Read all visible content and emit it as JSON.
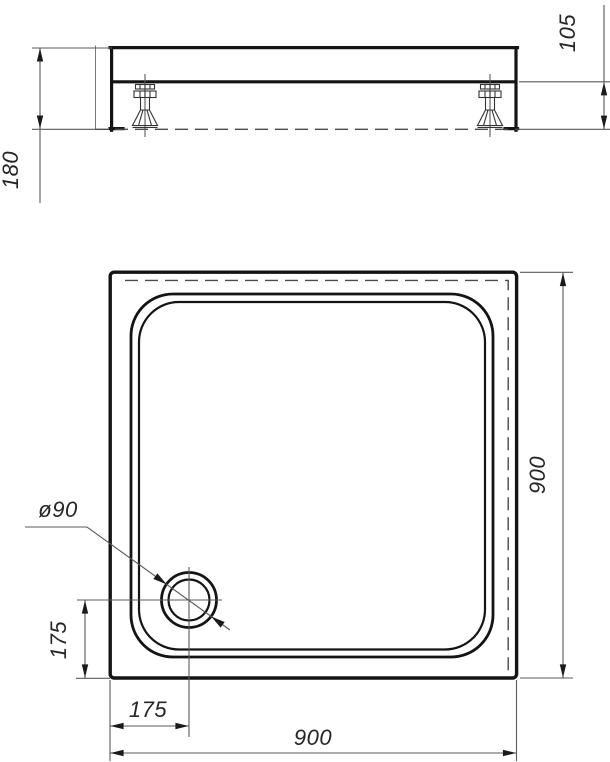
{
  "meta": {
    "kind": "technical dimension drawing",
    "subject": "square shower tray with corner drain, front elevation and plan view"
  },
  "colors": {
    "outline": "#141414",
    "thin_line": "#5a5a5a",
    "dashed_line": "#4a4a4a",
    "text": "#262626",
    "background": "#ffffff"
  },
  "side_view": {
    "name": "front-elevation",
    "dimensions": {
      "overall_height": "180",
      "underside_clearance_height": "105"
    }
  },
  "plan_view": {
    "name": "top-plan",
    "dimensions": {
      "outer_width": "900",
      "outer_depth": "900",
      "drain_diameter": "ø90",
      "drain_offset_from_left": "175",
      "drain_offset_from_bottom": "175"
    }
  }
}
